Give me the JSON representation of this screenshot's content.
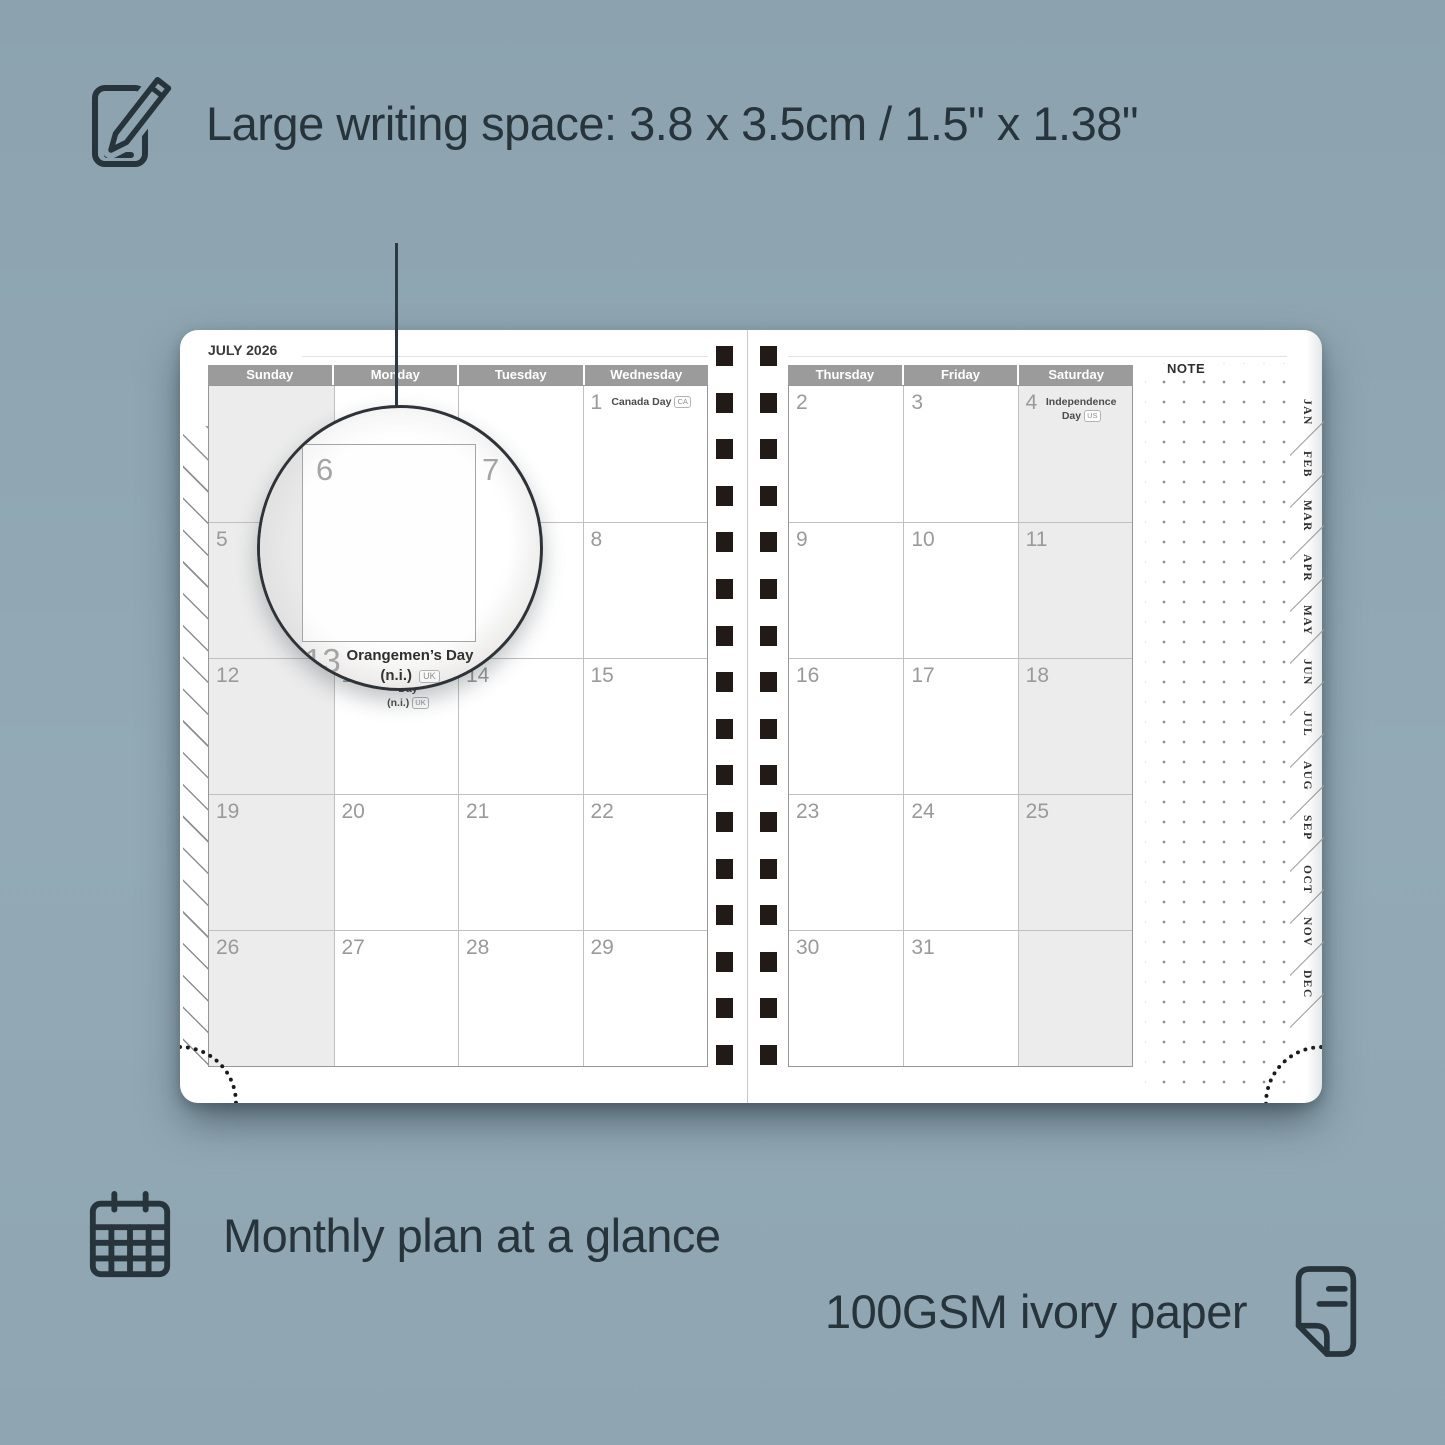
{
  "colors": {
    "background": "#90a7b3",
    "ink": "#28343c",
    "header_bar": "#9b9b9b",
    "shaded_cell": "#ececec",
    "spiral_hole": "#221a16",
    "day_number": "#9a9a9a"
  },
  "features": {
    "top": {
      "icon": "pencil-note-icon",
      "label": "Large writing space: 3.8 x 3.5cm / 1.5\" x 1.38\""
    },
    "monthly": {
      "icon": "calendar-grid-icon",
      "label": "Monthly plan at a glance"
    },
    "paper": {
      "icon": "paper-sheet-icon",
      "label": "100GSM ivory paper"
    }
  },
  "planner": {
    "title": "JULY 2026",
    "note_label": "NOTE",
    "left_day_headers": [
      "Sunday",
      "Monday",
      "Tuesday",
      "Wednesday"
    ],
    "right_day_headers": [
      "Thursday",
      "Friday",
      "Saturday"
    ],
    "month_tabs": [
      "JAN",
      "FEB",
      "MAR",
      "APR",
      "MAY",
      "JUN",
      "JUL",
      "AUG",
      "SEP",
      "OCT",
      "NOV",
      "DEC"
    ],
    "spiral_holes_per_column": 16,
    "left_grid": [
      [
        {},
        {},
        {},
        {
          "day": "1",
          "holiday_lines": [
            "Canada Day"
          ],
          "badge": "CA"
        }
      ],
      [
        {
          "day": "5"
        },
        {
          "day": "6"
        },
        {
          "day": "7"
        },
        {
          "day": "8"
        }
      ],
      [
        {
          "day": "12"
        },
        {
          "day": "13",
          "holiday_lines": [
            "Orangemen’s Day",
            "(n.i.)"
          ],
          "badge": "UK"
        },
        {
          "day": "14"
        },
        {
          "day": "15"
        }
      ],
      [
        {
          "day": "19"
        },
        {
          "day": "20"
        },
        {
          "day": "21"
        },
        {
          "day": "22"
        }
      ],
      [
        {
          "day": "26"
        },
        {
          "day": "27"
        },
        {
          "day": "28"
        },
        {
          "day": "29"
        }
      ]
    ],
    "right_grid": [
      [
        {
          "day": "2"
        },
        {
          "day": "3"
        },
        {
          "day": "4",
          "holiday_lines": [
            "Independence Day"
          ],
          "badge": "US"
        }
      ],
      [
        {
          "day": "9"
        },
        {
          "day": "10"
        },
        {
          "day": "11"
        }
      ],
      [
        {
          "day": "16"
        },
        {
          "day": "17"
        },
        {
          "day": "18"
        }
      ],
      [
        {
          "day": "23"
        },
        {
          "day": "24"
        },
        {
          "day": "25"
        }
      ],
      [
        {
          "day": "30"
        },
        {
          "day": "31"
        },
        {}
      ]
    ]
  },
  "magnifier": {
    "day_left": "6",
    "day_right": "7",
    "day_bottom": "13",
    "holiday_line1": "Orangemen’s Day",
    "holiday_line2": "(n.i.)",
    "holiday_badge": "UK"
  }
}
